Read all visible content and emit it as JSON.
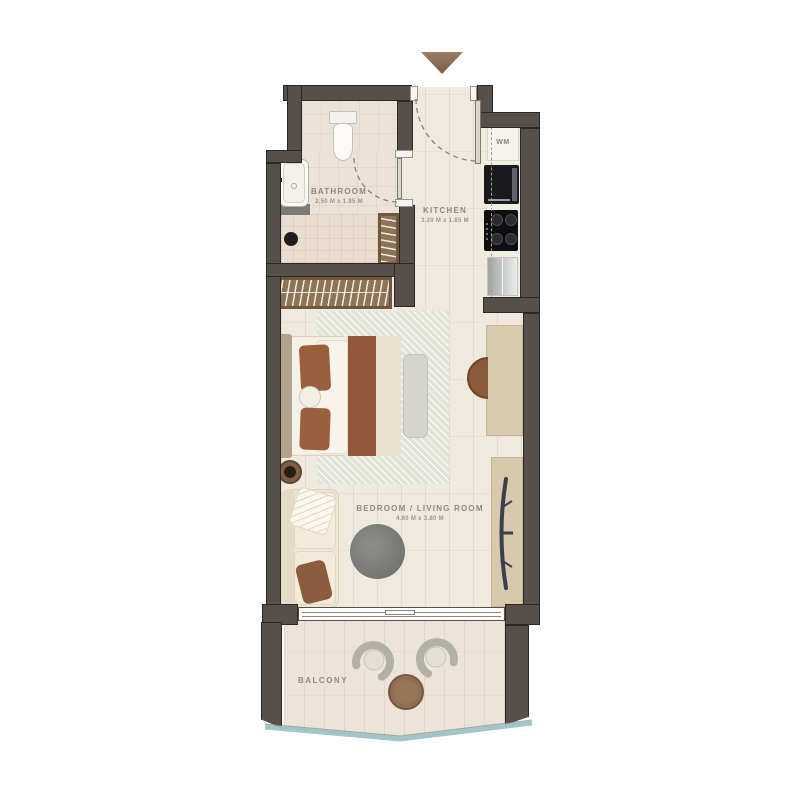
{
  "plan": {
    "title": "studio-apartment-floor-plan",
    "rooms": {
      "bathroom": {
        "name": "BATHROOM",
        "dims": "2.50 M x 1.85 M"
      },
      "kitchen": {
        "name": "KITCHEN",
        "dims": "3.20 M x 1.85 M"
      },
      "bedroom": {
        "name": "BEDROOM / LIVING ROOM",
        "dims": "4.60 M x 3.80 M"
      },
      "balcony": {
        "name": "BALCONY"
      }
    },
    "appliances": {
      "washing_machine": "WM"
    },
    "colors": {
      "wall": "#57504a",
      "floor": "#f0e9de",
      "bathroom_tile": "#ece2d7",
      "accent_rust": "#96593a",
      "wood": "#d9c9af",
      "railing_glass": "#9cc2c6",
      "entry_arrow": "#8b6d54",
      "label_text": "#8f897d"
    }
  }
}
